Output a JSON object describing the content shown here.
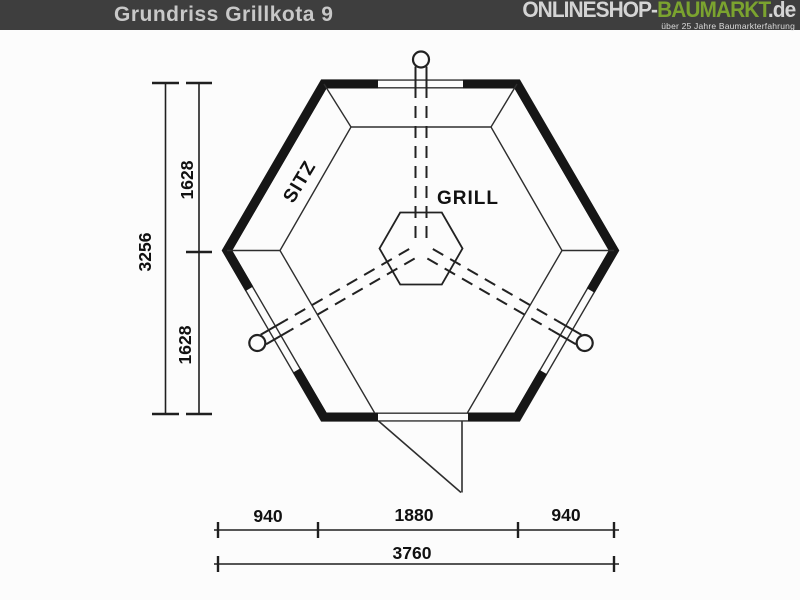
{
  "header": {
    "title": "Grundriss Grillkota 9",
    "logo": {
      "part_shop": "ONLINESHOP-",
      "part_markt": "BAUMARKT",
      "part_de": ".de",
      "tagline": "über 25 Jahre Baumarkterfahrung"
    },
    "colors": {
      "bar_background": "#3e3e3e",
      "title_text": "#c8c8c8",
      "logo_light": "#d4d4d4",
      "logo_green": "#7ba32f"
    }
  },
  "drawing": {
    "kind": "hexagonal grill hut floor plan",
    "labels": {
      "seat": "SITZ",
      "grill": "GRILL"
    },
    "dimensions": {
      "left_total": "3256",
      "left_upper": "1628",
      "left_lower": "1628",
      "bottom_left": "940",
      "bottom_center": "1880",
      "bottom_right": "940",
      "bottom_total": "3760"
    },
    "line_color": "#1f1f1f"
  }
}
